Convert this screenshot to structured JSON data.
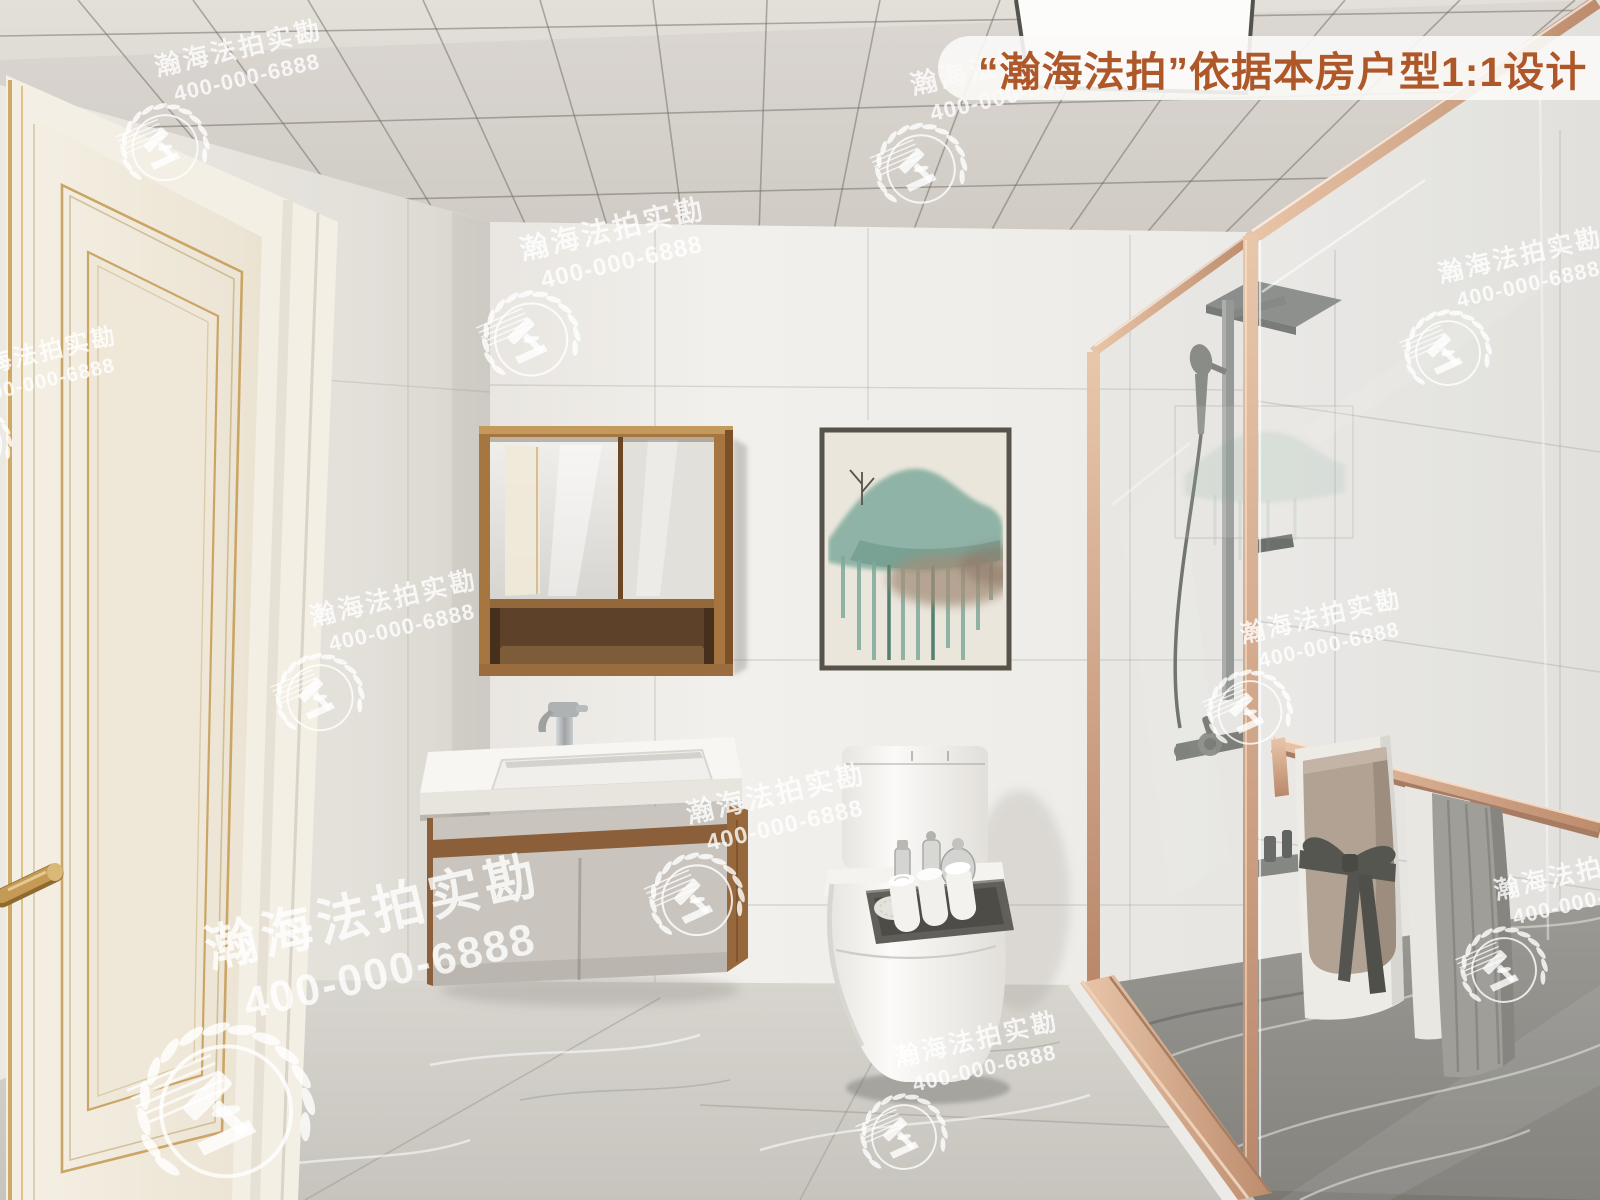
{
  "banner": {
    "text": "“瀚海法拍”依据本房户型1:1设计",
    "text_color": "#ae582a",
    "background": "rgba(251,250,247,0.9)"
  },
  "watermark": {
    "brand": "瀚海法拍实勘",
    "phone": "400-000-6888",
    "color": "rgba(255,255,255,0.8)",
    "emblem": "gavel-laurel-badge"
  },
  "scene": {
    "type": "3d-interior-render",
    "room": "bathroom",
    "palette": {
      "ceiling": "#dedad4",
      "walls": "#f0eeea",
      "door": "#f2ecdf",
      "door_trim_gold": "#c9a469",
      "cabinet_wood": "#a5763f",
      "rose_gold_frame": "#d6a88c",
      "floor_marble": "#cfccc6",
      "shower_floor_marble": "#8a8781",
      "art_teal": "#8fb3a6",
      "towel_taupe": "#b2a293",
      "towel_gray": "#a09e98"
    },
    "objects": [
      "paneled-door",
      "ceiling-grid",
      "led-panel",
      "mirror-cabinet",
      "wall-art",
      "vanity",
      "faucet",
      "toilet",
      "toiletry-tray",
      "shower-enclosure",
      "shower-set",
      "towel-bar",
      "towels",
      "marble-floor"
    ]
  }
}
